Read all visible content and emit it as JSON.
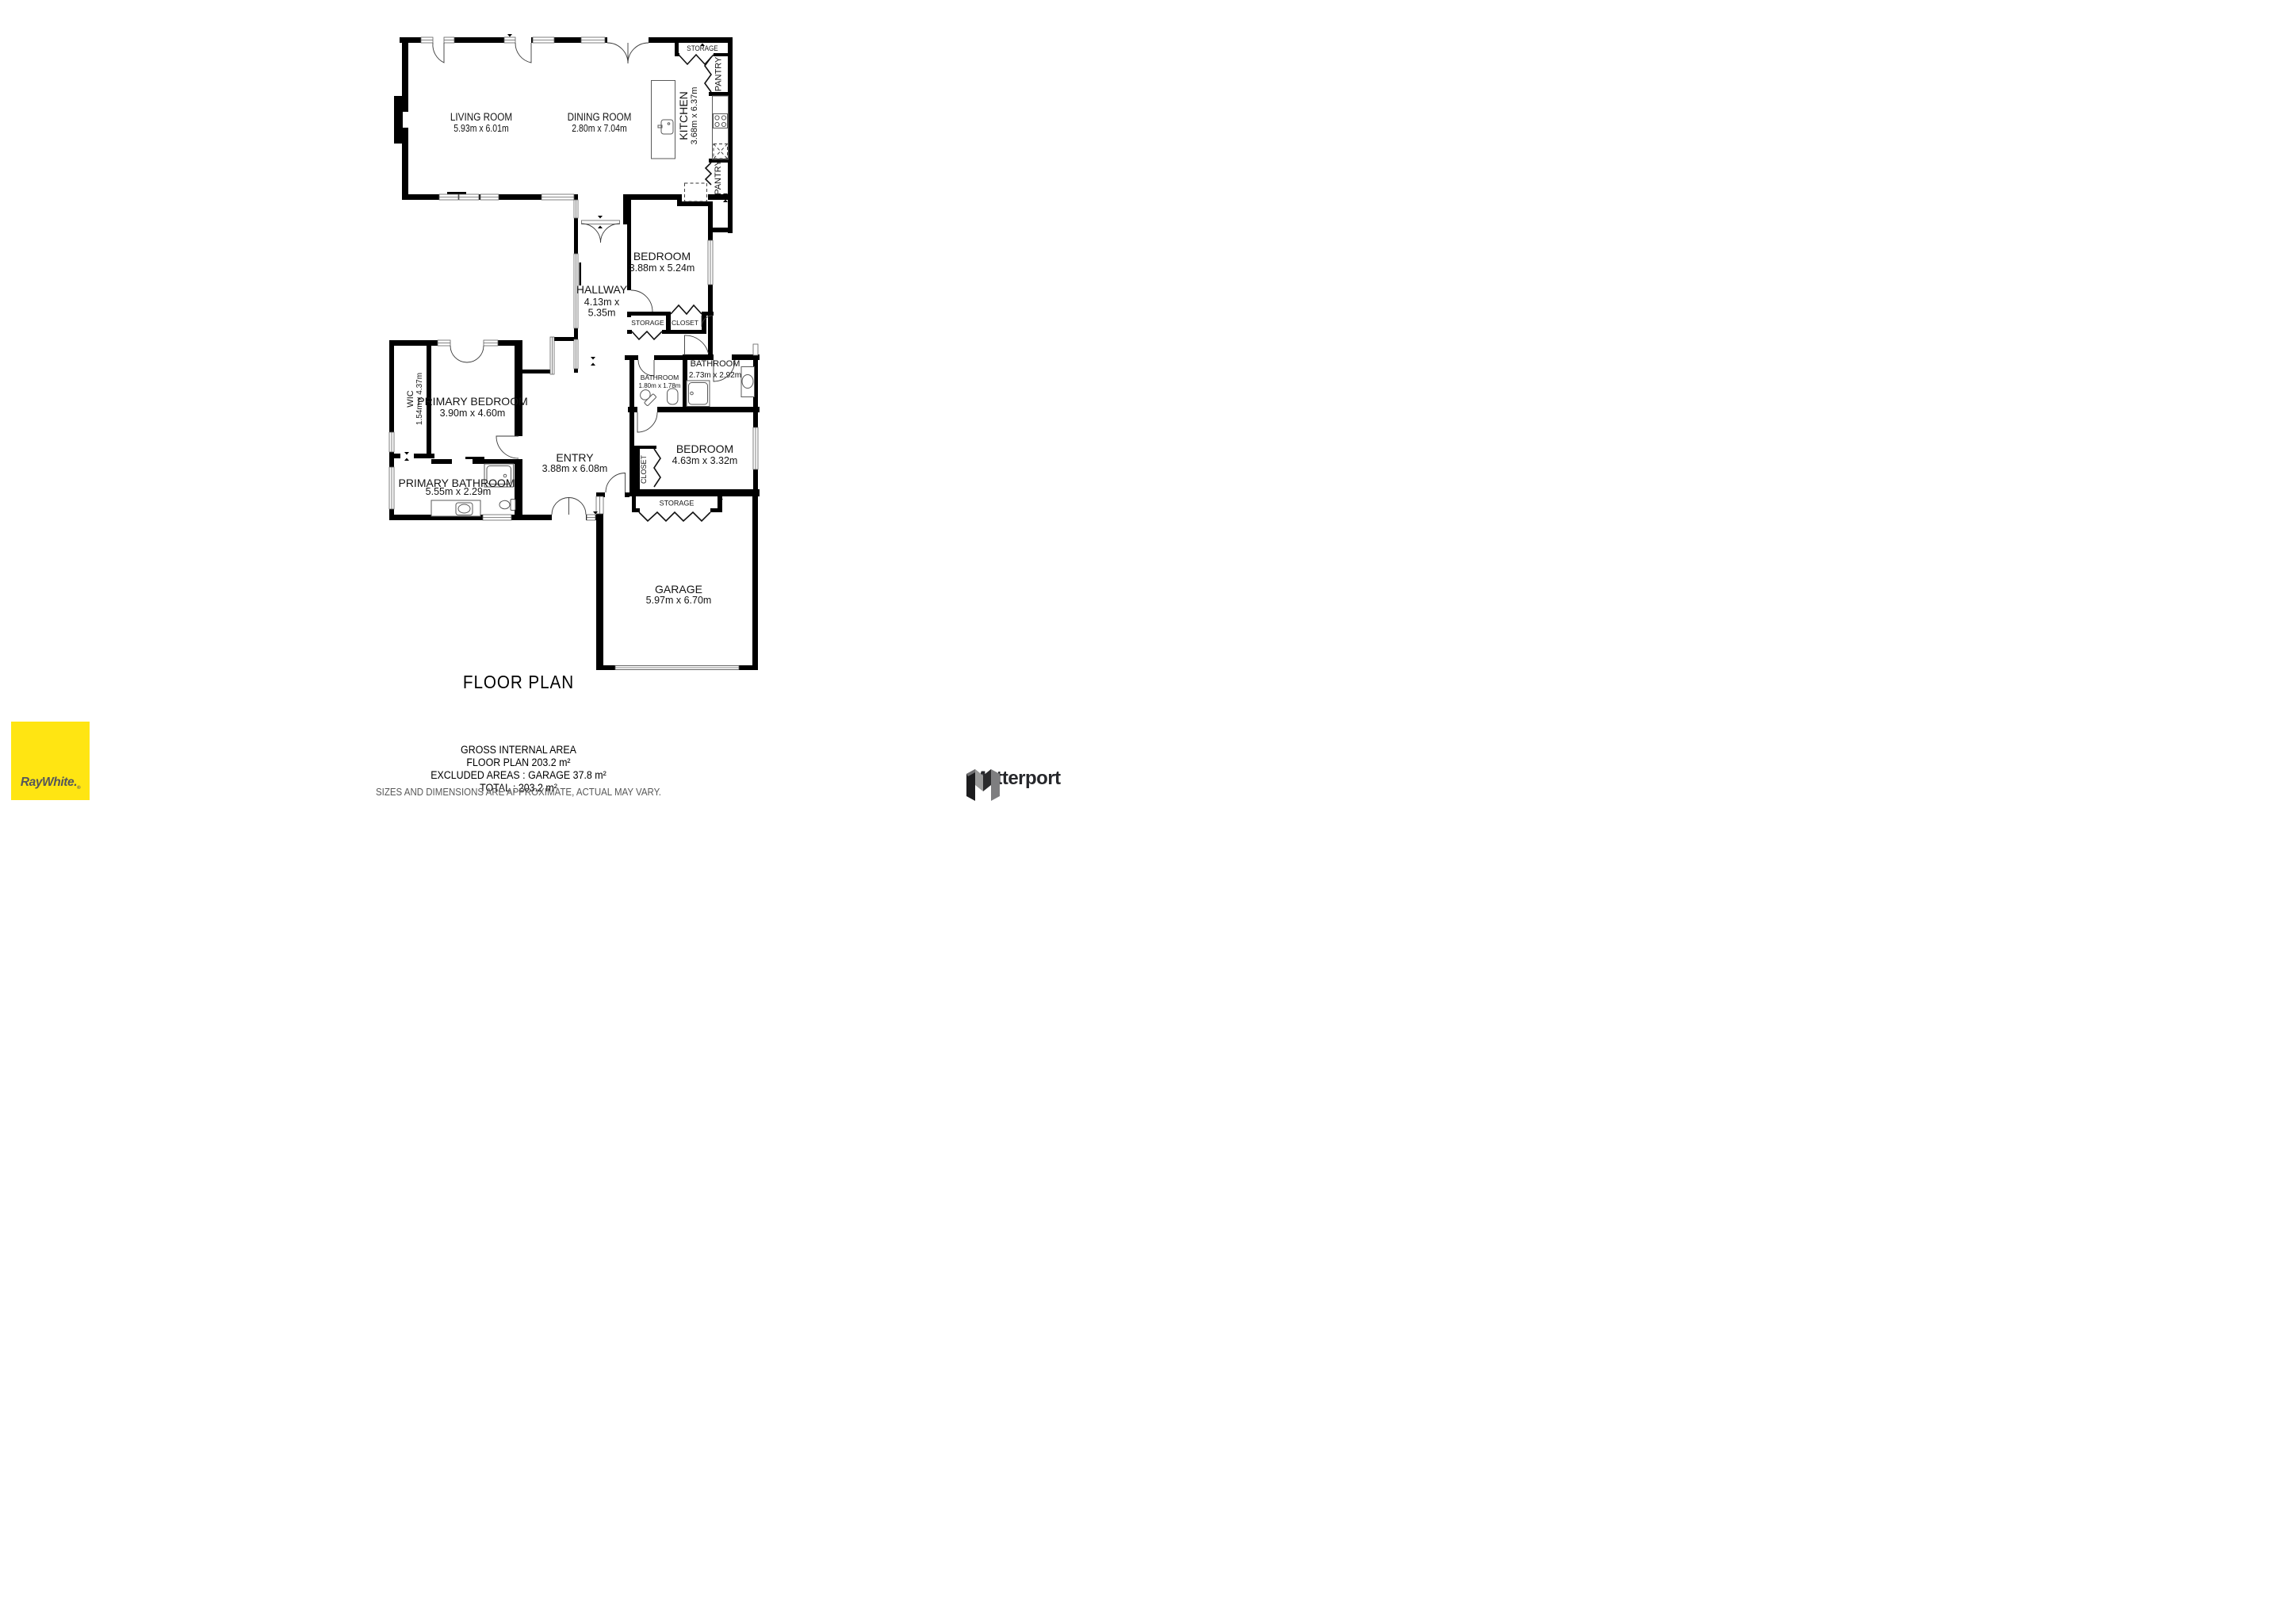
{
  "title": "FLOOR PLAN",
  "rooms": {
    "living": {
      "name": "LIVING ROOM",
      "dims": "5.93m x 6.01m"
    },
    "dining": {
      "name": "DINING ROOM",
      "dims": "2.80m x 7.04m"
    },
    "kitchen": {
      "name": "KITCHEN",
      "dims": "3.68m x 6.37m"
    },
    "storage_kitchen": {
      "name": "STORAGE"
    },
    "pantry_upper": {
      "name": "PANTRY"
    },
    "pantry_lower": {
      "name": "PANTRY"
    },
    "hallway": {
      "name": "HALLWAY",
      "dims_line1": "4.13m x",
      "dims_line2": "5.35m"
    },
    "bedroom": {
      "name": "BEDROOM",
      "dims": "3.88m x 5.24m"
    },
    "storage_hall": {
      "name": "STORAGE"
    },
    "closet_hall": {
      "name": "CLOSET"
    },
    "bathroom_small": {
      "name": "BATHROOM",
      "dims": "1.80m x 1.78m"
    },
    "bathroom": {
      "name": "BATHROOM",
      "dims": "2.73m x 2.92m"
    },
    "bedroom2": {
      "name": "BEDROOM",
      "dims": "4.63m x 3.32m"
    },
    "closet_bedroom": {
      "name": "CLOSET"
    },
    "storage_garage": {
      "name": "STORAGE"
    },
    "wic": {
      "name": "WIC",
      "dims": "1.54m x 4.37m"
    },
    "primary_bedroom": {
      "name": "PRIMARY BEDROOM",
      "dims": "3.90m x 4.60m"
    },
    "primary_bathroom": {
      "name": "PRIMARY BATHROOM",
      "dims": "5.55m x 2.29m"
    },
    "entry": {
      "name": "ENTRY",
      "dims": "3.88m x 6.08m"
    },
    "garage": {
      "name": "GARAGE",
      "dims": "5.97m x 6.70m"
    }
  },
  "footer": {
    "area_title": "GROSS INTERNAL AREA",
    "area_line1": "FLOOR PLAN 203.2 m²",
    "area_line2": "EXCLUDED AREAS :  GARAGE 37.8 m²",
    "area_line3": "TOTAL :  203.2 m²",
    "disclaimer": "SIZES AND DIMENSIONS ARE APPROXIMATE, ACTUAL MAY VARY."
  },
  "branding": {
    "raywhite": {
      "label": "RayWhite.",
      "mark": "®",
      "bg_color": "#FFE512",
      "text_color": "#54565B"
    },
    "matterport": {
      "label": "Matterport",
      "text_color": "#26272B"
    }
  }
}
